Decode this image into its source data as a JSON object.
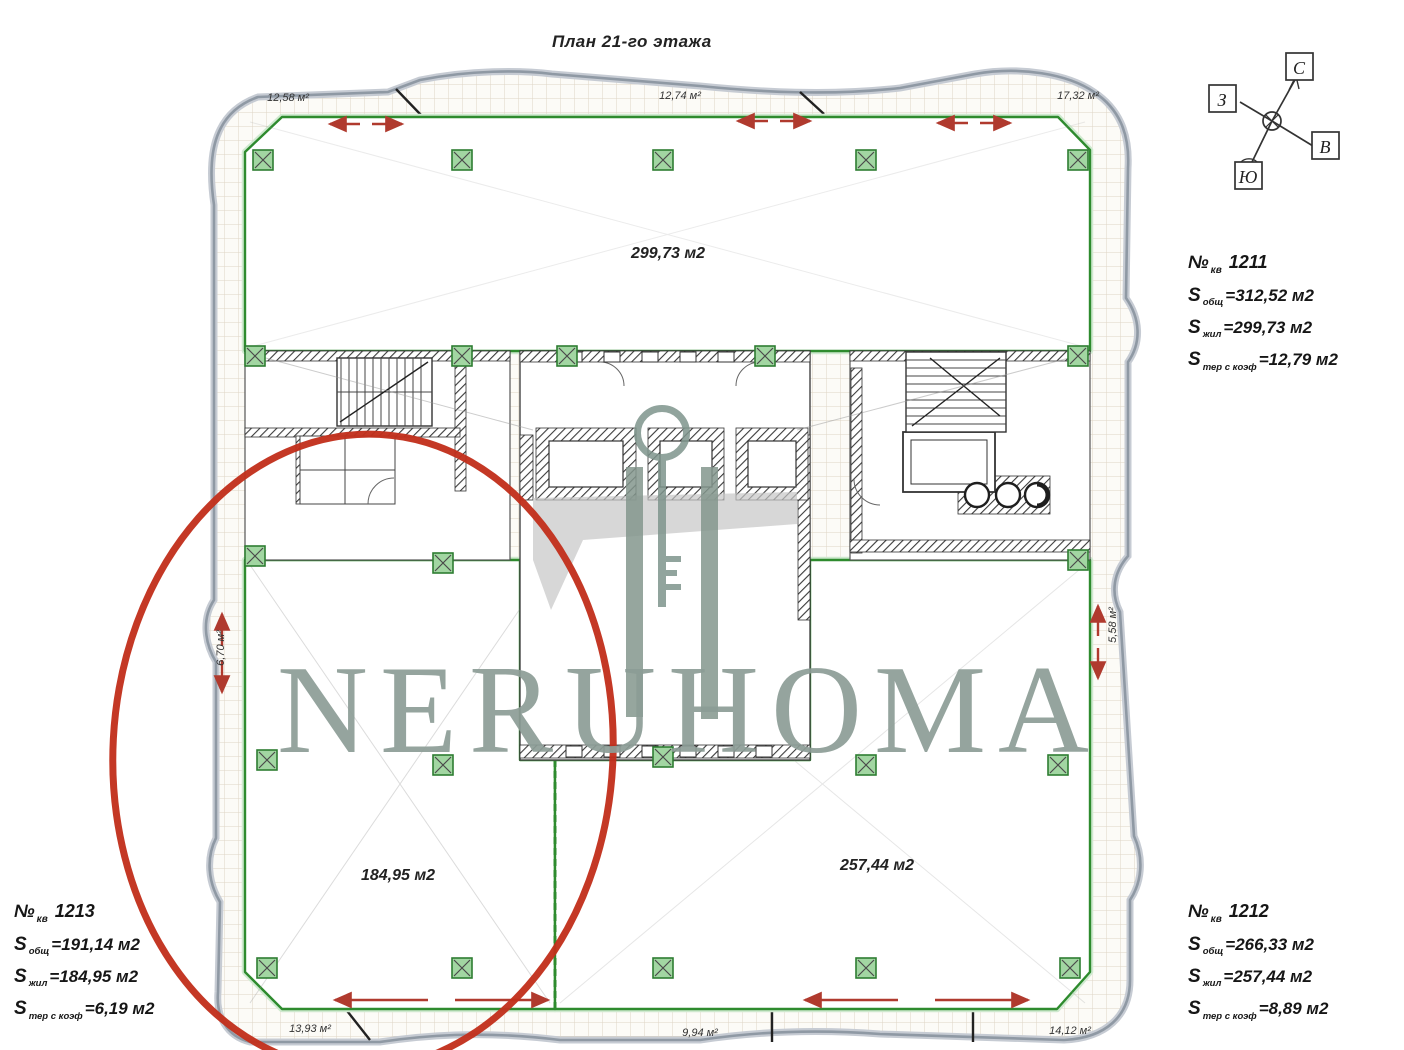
{
  "title": "План 21-го этажа",
  "watermark": "NERUHOMA",
  "compass": {
    "north": "С",
    "west": "З",
    "east": "В",
    "south": "Ю"
  },
  "apartments": [
    {
      "number_prefix": "№",
      "number_sub": "кв",
      "number": "1211",
      "rows": [
        {
          "label": "S",
          "sub": "общ",
          "value": "=312,52 м2"
        },
        {
          "label": "S",
          "sub": "жил",
          "value": "=299,73 м2"
        },
        {
          "label": "S",
          "sub": "тер с коэф",
          "value": "=12,79 м2"
        }
      ]
    },
    {
      "number_prefix": "№",
      "number_sub": "кв",
      "number": "1213",
      "rows": [
        {
          "label": "S",
          "sub": "общ",
          "value": "=191,14 м2"
        },
        {
          "label": "S",
          "sub": "жил",
          "value": "=184,95 м2"
        },
        {
          "label": "S",
          "sub": "тер с коэф",
          "value": "=6,19 м2"
        }
      ]
    },
    {
      "number_prefix": "№",
      "number_sub": "кв",
      "number": "1212",
      "rows": [
        {
          "label": "S",
          "sub": "общ",
          "value": "=266,33 м2"
        },
        {
          "label": "S",
          "sub": "жил",
          "value": "=257,44 м2"
        },
        {
          "label": "S",
          "sub": "тер с коэф",
          "value": "=8,89 м2"
        }
      ]
    }
  ],
  "plan": {
    "room_areas": [
      {
        "name": "top-apartment",
        "label": "299,73 м2"
      },
      {
        "name": "bottom-left-apartment",
        "label": "184,95 м2"
      },
      {
        "name": "bottom-right-apartment",
        "label": "257,44 м2"
      }
    ],
    "balcony_areas": [
      {
        "position": "top-left",
        "label": "12,58 м²"
      },
      {
        "position": "top-middle",
        "label": "12,74 м²"
      },
      {
        "position": "top-right",
        "label": "17,32 м²"
      },
      {
        "position": "left",
        "label": "6,70 м²"
      },
      {
        "position": "right",
        "label": "5,58 м²"
      },
      {
        "position": "bottom-left",
        "label": "13,93 м²"
      },
      {
        "position": "bottom-middle",
        "label": "9,94 м²"
      },
      {
        "position": "bottom-right",
        "label": "14,12 м²"
      }
    ]
  },
  "colors": {
    "highlight_ellipse": "#c2301c",
    "boundary_green": "#2e8b2e",
    "watermark_green": "#8c9d96",
    "contour_gray": "#99a3ae",
    "arrow_red": "#b03a2e"
  }
}
